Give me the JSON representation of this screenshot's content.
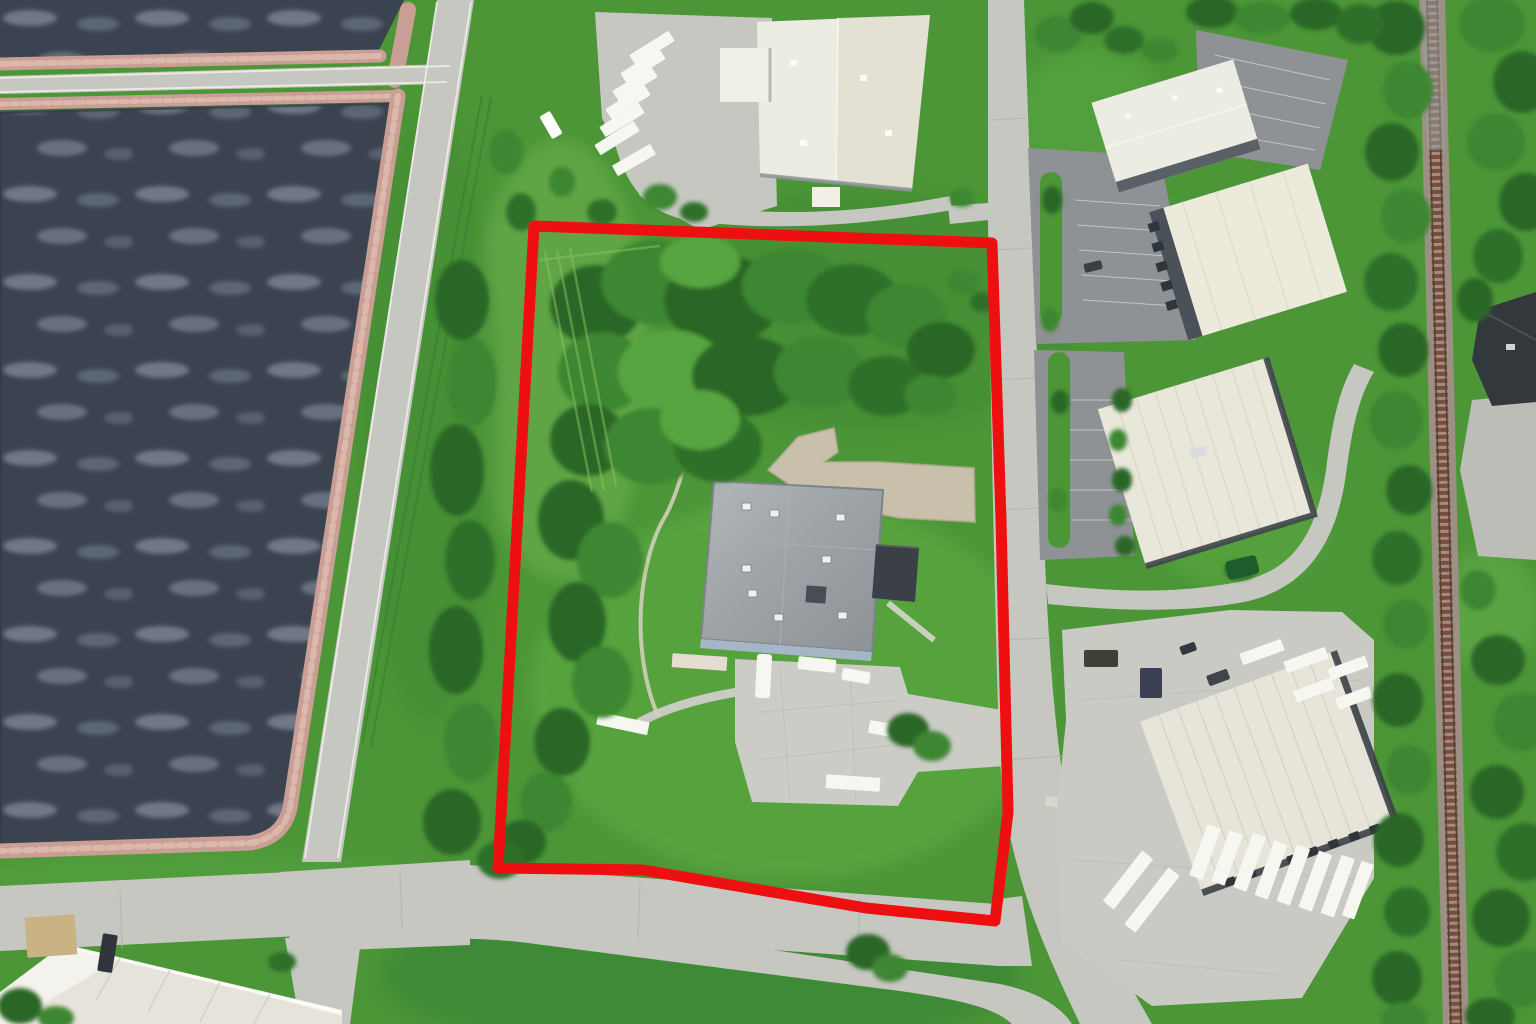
{
  "scene": {
    "type": "aerial-photograph",
    "title": "Industrial park aerial photograph with red-outlined parcel",
    "labels": {
      "photo": "Aerial photograph of an industrial park beside treatment lagoons and a railroad",
      "parcel": "Red-outlined subject parcel",
      "parcel_building": "Gray flat-roof industrial building with dark annex",
      "parcel_apron": "Concrete truck apron",
      "gravel_pad": "Gravel pad",
      "lagoon_upper": "Treatment lagoon upper cell",
      "lagoon_lower": "Treatment lagoon lower cell",
      "embankment_road": "Lagoon embankment road",
      "street_vertical": "North-south industrial street",
      "street_main": "East-west street",
      "street_branch": "Lower access road",
      "railroad": "Railroad corridor",
      "north_building": "White warehouse with trailer yard",
      "northeast_building_1": "White flex building (north)",
      "northeast_building_2": "White flex building (east, dock doors)",
      "east_building": "White flex building (middle)",
      "southeast_warehouse": "Distribution warehouse with docked trailers",
      "southwest_building": "White industrial building (partial, lower left)",
      "east_house": "Dark-roof building beside railroad",
      "trees": "Tree cover",
      "grass": "Grass and lawn"
    },
    "parcel": {
      "outline_color": "#ee1010",
      "outline_width": 11,
      "outline_points": "534,226 992,243 1001,520 1008,812 995,921 866,908 643,870 498,868"
    },
    "palette": {
      "grass": "#4c9638",
      "grass_light": "#68ae49",
      "grass_dark": "#337a2c",
      "tree_dark": "#2a6626",
      "tree_mid": "#3c8631",
      "tree_light": "#57a53f",
      "water": "#3b4350",
      "water_mottle": "#98a1b1",
      "riprap": "#c99f95",
      "road": "#c6c7c1",
      "asphalt": "#8f9294",
      "gravel": "#c9c0ac",
      "roof_white": "#edece2",
      "roof_flex": "#e9e7da",
      "roof_gray": "#9ba0a4",
      "roof_annex": "#3a4046",
      "rail_ties": "#7c4b3b",
      "rail_ballast": "#9b9083",
      "trailer": "#f7f7f2"
    },
    "counts": {
      "north_yard_trailers": 7,
      "southeast_docked_trailers": 8,
      "parcel_vehicles": 6
    }
  }
}
